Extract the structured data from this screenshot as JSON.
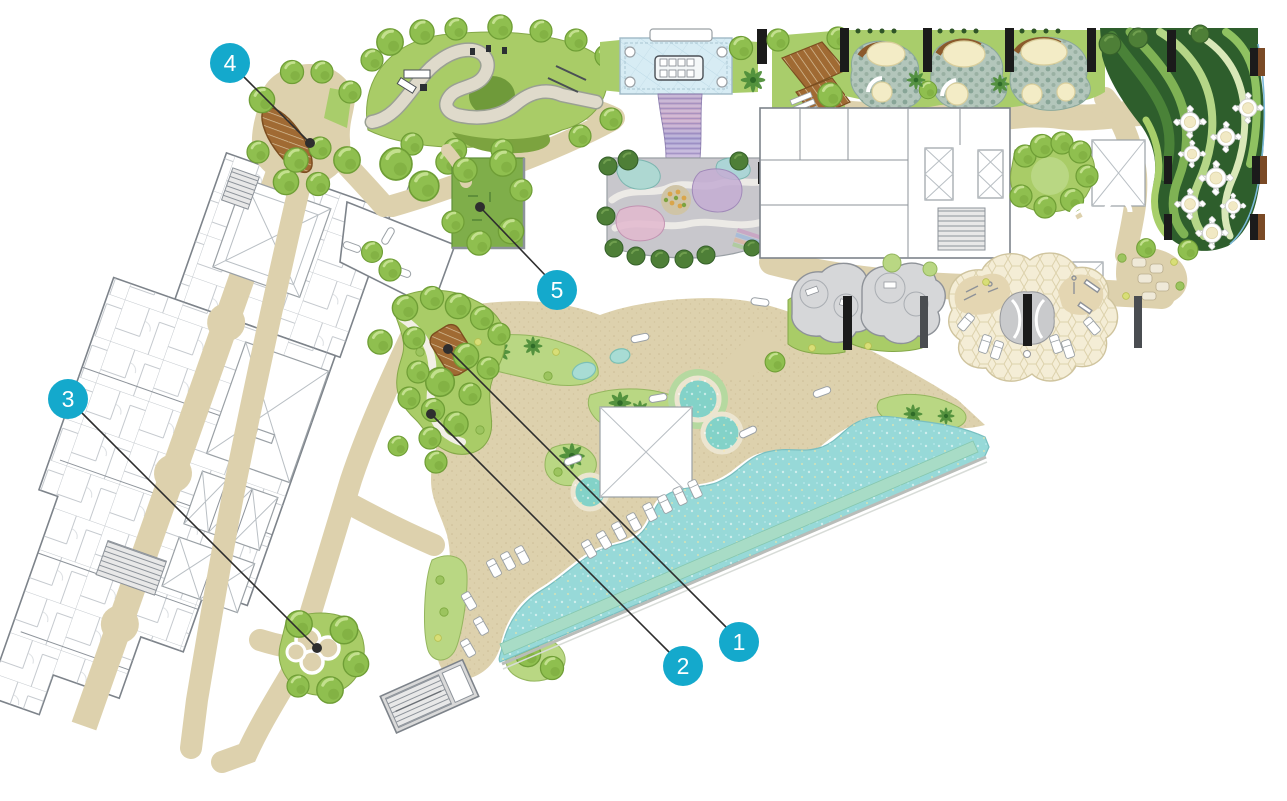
{
  "plan": {
    "type": "landscape-site-plan",
    "callout_count": "5"
  },
  "markers": [
    {
      "label": "1"
    },
    {
      "label": "2"
    },
    {
      "label": "3"
    },
    {
      "label": "4"
    },
    {
      "label": "5"
    }
  ],
  "icons": {
    "marker_shape": "numbered-circle-hotspot",
    "leader_style": "line-with-dot"
  },
  "colors": {
    "marker_accent": "#14a9cc",
    "marker_text": "#ffffff",
    "leader_line": "#2e2e2e",
    "pool_water": "#97d9d8",
    "lap_pool": "#a8dcc6",
    "path_tan": "#ddd1ad",
    "lawn_green": "#a9cd6b",
    "tree_green": "#8fbf4f",
    "deck_wood": "#a06a33",
    "playground_paving": "#c8c7cc",
    "building_linework": "#7d838a",
    "dining_garden_dark_green": "#2e5e2c",
    "background": "#ffffff"
  }
}
